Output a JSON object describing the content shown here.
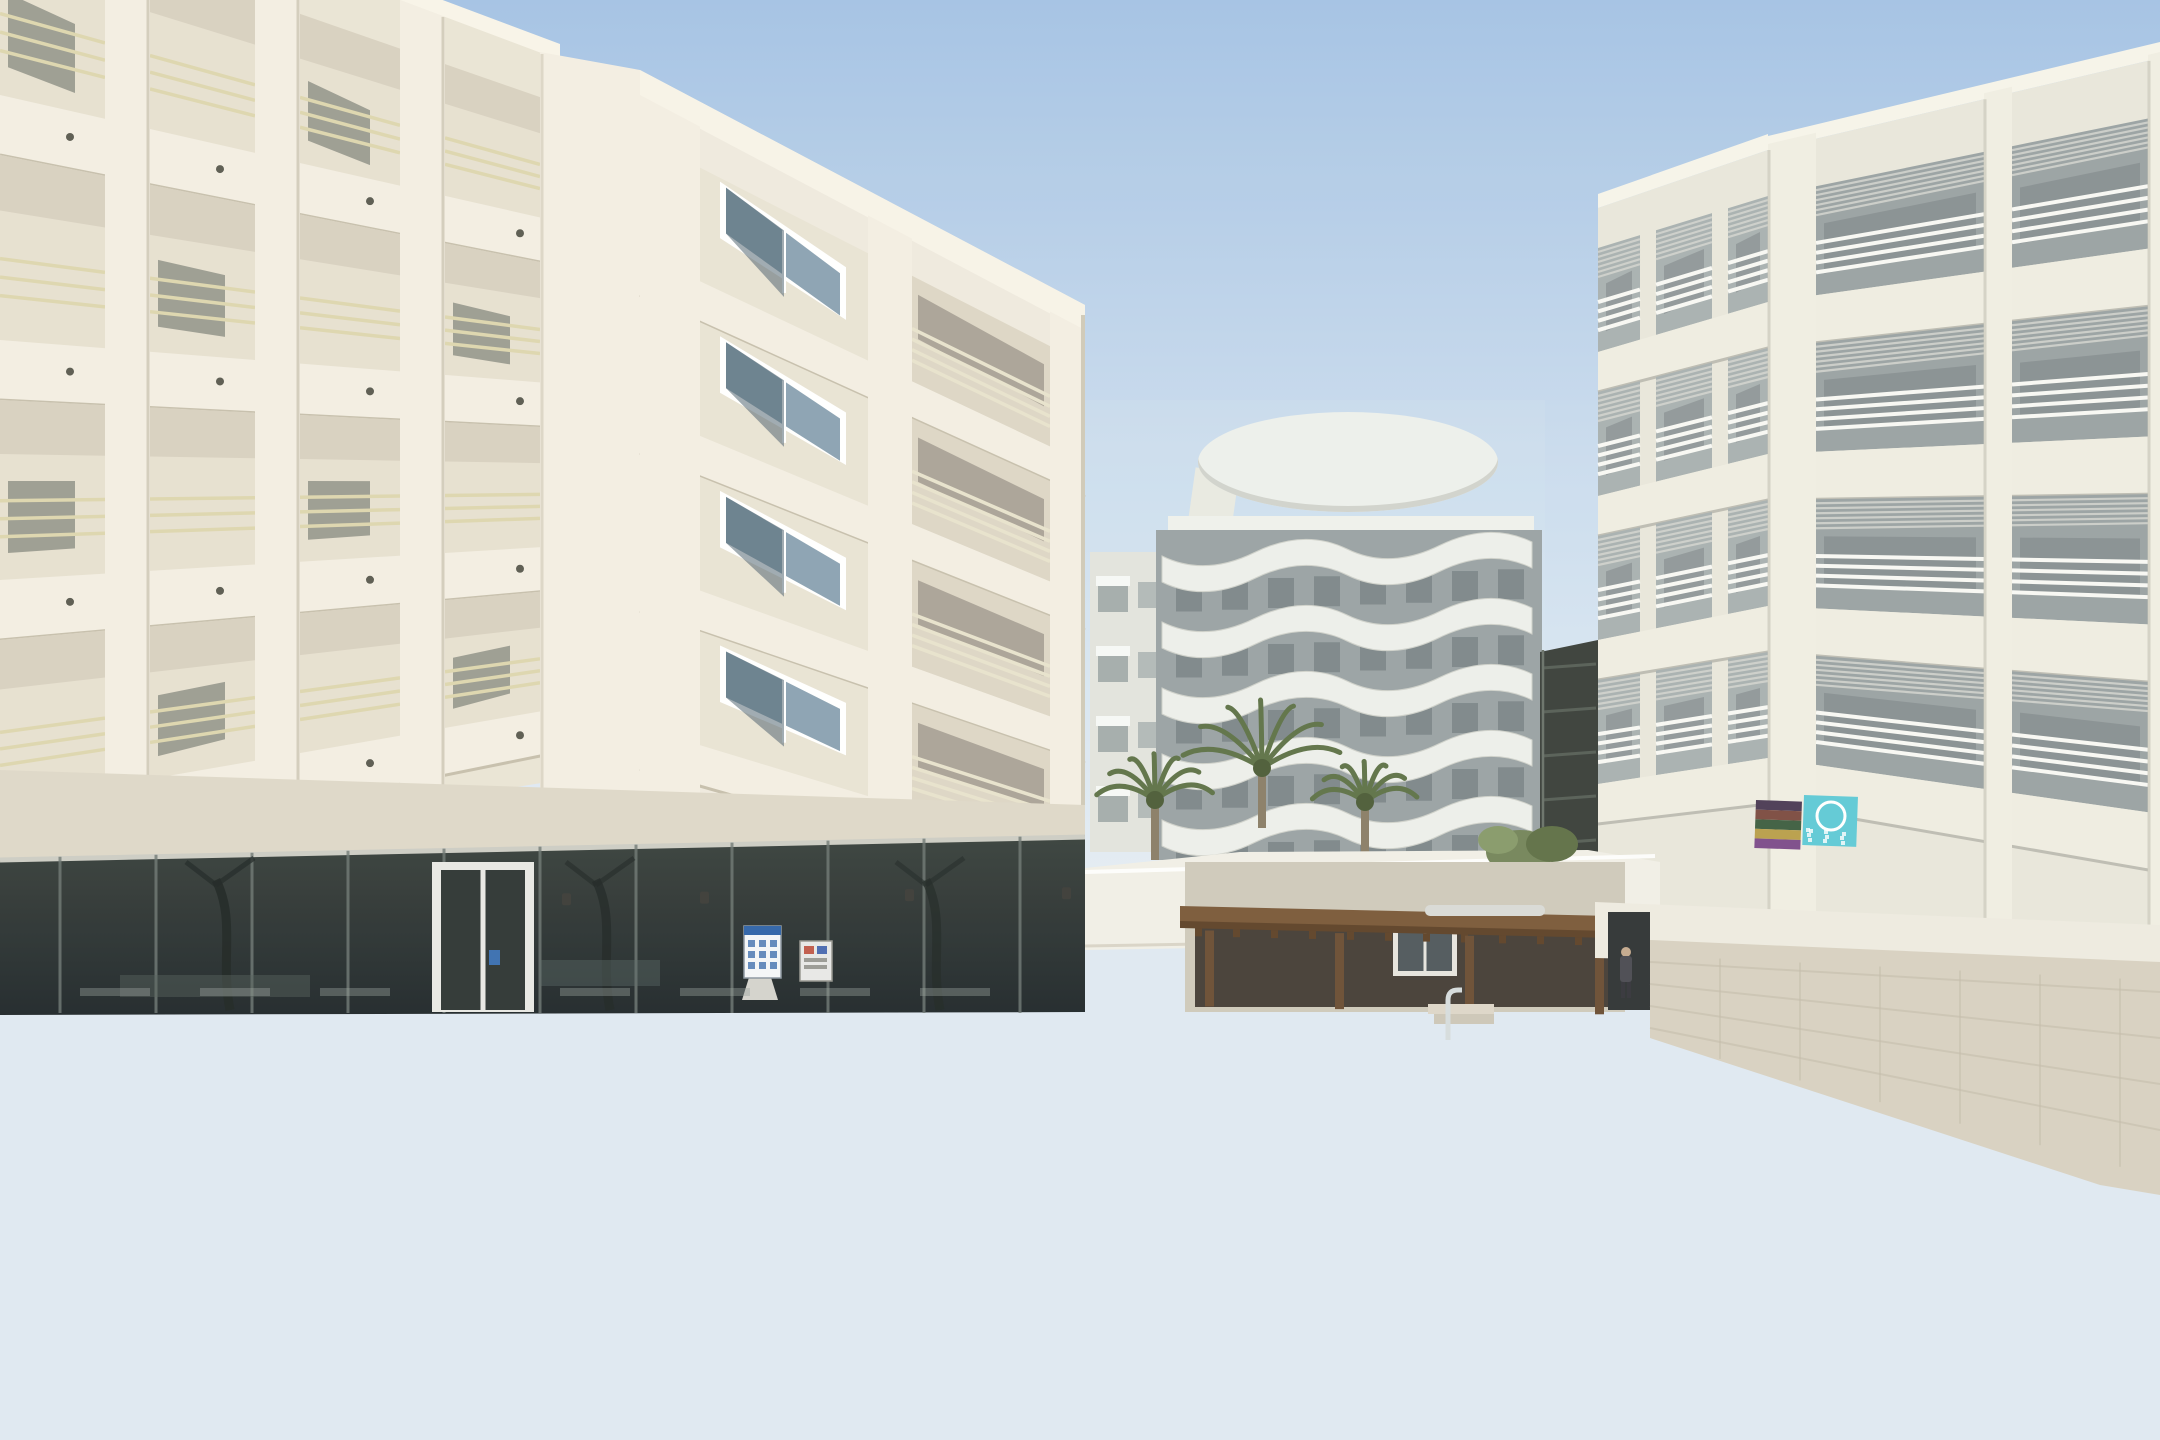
{
  "image": {
    "alt": "Sunny hotel courtyard: white apartment buildings with balconies surround a curvy blue swimming pool with a row of in-pool mosaic stools, chrome safety fence, two pool ladders, cream sun loungers, closed parasols, terrace chairs, a wooden pool bar pergola, palm fronds in the left foreground, an orange lifebuoy on the right wall and beach towels on a balcony rail."
  },
  "palette": {
    "sky_top": "#a9c6e6",
    "sky_mid": "#c9dbee",
    "sky_low": "#e3ecf4",
    "cream_light": "#f3eee2",
    "cream": "#eae4d5",
    "cream_shadow": "#d9d2bf",
    "slab_shadow": "#c6bfac",
    "rail_yellow": "#ddd6ae",
    "tower_face": "#efeade",
    "glass_dark": "#343d3a",
    "glass_mullion": "#6e7874",
    "right_face": "#e9e7db",
    "right_cell": "#9aa2a3",
    "right_rail": "#f8f8f4",
    "slat": "#d3d5cf",
    "wavy_white": "#f0f0ea",
    "wavy_dark": "#8e9697",
    "shaft": "#3a3f3a",
    "wood": "#7a5939",
    "wood_dark": "#5e4228",
    "bar_interior": "#453e37",
    "stone_wall": "#d8d1c1",
    "white_wall": "#eeebe0",
    "deck": "#e9e3d5",
    "deck_bright": "#f3edde",
    "deck_warm": "#e6d6c0",
    "terrace_shade": "#d7d2c5",
    "coping": "#d8a97c",
    "coping_dark": "#c08d62",
    "water_top": "#2e97cf",
    "water_main": "#6cbede",
    "water_right": "#2b86ba",
    "water_shallow": "#d7ecf4",
    "waterline_dark": "#15597f",
    "mosaic_band": "#7cc3de",
    "stool_cap": "#f4f6f2",
    "mosaic1": "#6fa9c8",
    "mosaic2": "#93c6da",
    "stool_shadow": "#1d6f9e",
    "bench_band": "#a7cdd3",
    "chrome": "#d6dcdd",
    "chrome_dark": "#8d989c",
    "chrome_bright": "#f2f5f4",
    "umbrella_cream": "#e9dcc0",
    "umbrella_white": "#efece4",
    "palm": "#7f9455",
    "palm_dark": "#5c7040",
    "lifebuoy_orange": "#e2683a",
    "towel_teal": "#5fc9d6",
    "pink": "#d86f9c",
    "lamp_grey": "#8f9496",
    "bin_grey": "#9aa2a4",
    "person_dark": "#4a4a52"
  },
  "left_building": {
    "faceA": {
      "x0": 0,
      "x1": 560,
      "ys0": [
        -150,
        95,
        340,
        580,
        805
      ],
      "ys1": [
        60,
        222,
        384,
        546,
        708
      ],
      "th0": 60,
      "th1": 44,
      "bays": [
        [
          0,
          105
        ],
        [
          150,
          255
        ],
        [
          300,
          400
        ],
        [
          445,
          540
        ]
      ]
    },
    "faceB": {
      "x0": 640,
      "x1": 1085,
      "ys0": [
        95,
        253,
        411,
        569,
        727
      ],
      "ys1": [
        330,
        463,
        596,
        729,
        862
      ],
      "th0": 42,
      "th1": 34,
      "window_bay": [
        700,
        868
      ],
      "balcony_bay": [
        912,
        1050
      ]
    }
  },
  "right_building": {
    "main": {
      "x0": 1768,
      "x1": 2160,
      "ys0": [
        150,
        302,
        454,
        606,
        758
      ],
      "ys1": [
        58,
        247,
        436,
        625,
        814
      ],
      "th0": 46,
      "th1": 58,
      "bays": [
        [
          1816,
          1984
        ],
        [
          2012,
          2148
        ]
      ],
      "piers": [
        [
          1768,
          1816
        ],
        [
          1984,
          2012
        ],
        [
          2148,
          2160
        ]
      ]
    },
    "wing": {
      "x0": 1598,
      "x1": 1768,
      "ys0": [
        208,
        352,
        496,
        640,
        784
      ],
      "ys1": [
        150,
        302,
        454,
        606,
        758
      ],
      "th0": 40,
      "th1": 46,
      "bays": [
        [
          1598,
          1640
        ],
        [
          1656,
          1712
        ],
        [
          1728,
          1768
        ]
      ]
    }
  },
  "wavy_building": {
    "x0": 1162,
    "x1": 1532,
    "rows": 5,
    "y_start": 556,
    "pitch": 66,
    "slope": -14,
    "amp": 15,
    "band_h": 26,
    "crown": {
      "cx": 1348,
      "cy": 462,
      "rx": 150,
      "ry": 50
    }
  },
  "fence": {
    "bar_step": 17,
    "sections": [
      {
        "x0": 597,
        "yt0": 1012,
        "x1": 1105,
        "yt1": 1008,
        "yb0": 1095,
        "yb1": 1118,
        "posts": [
          597,
          766,
          935,
          1104
        ]
      },
      {
        "x0": 1105,
        "yt0": 1008,
        "x1": 1450,
        "yt1": 1052,
        "yb0": 1118,
        "yb1": 1205,
        "posts": [
          1277,
          1450
        ]
      },
      {
        "x0": 1450,
        "yt0": 1052,
        "x1": 1622,
        "yt1": 1086,
        "yb0": 1205,
        "yb1": 1250,
        "posts": [
          1622
        ]
      }
    ],
    "end_post": {
      "x": 1622,
      "y0": 1086,
      "y1": 1345
    }
  },
  "stools": {
    "count": 18,
    "x0": 622,
    "y0": 1120,
    "x1": 1520,
    "y1": 1323
  },
  "chair_rows": [
    {
      "x0": 1235,
      "x1": 1585,
      "y": 1004,
      "s": 0.72,
      "step": 25,
      "frame": "#6e6253",
      "dark": "#514538"
    },
    {
      "x0": 636,
      "x1": 1235,
      "y": 1012,
      "s": 0.8,
      "step": 28,
      "frame": "#a59880",
      "dark": "#7d7260"
    },
    {
      "x0": 520,
      "x1": 1150,
      "y": 1058,
      "s": 0.95,
      "step": 30,
      "frame": "#b3a78d",
      "dark": "#887d67"
    },
    {
      "x0": 1150,
      "x1": 1478,
      "y": 1062,
      "s": 0.95,
      "step": 31,
      "frame": "#ab9f87",
      "dark": "#81765f"
    }
  ],
  "tables": [
    {
      "x": 880,
      "y": 1000,
      "w": 64
    },
    {
      "x": 1010,
      "y": 998,
      "w": 64
    },
    {
      "x": 1140,
      "y": 1000,
      "w": 60
    }
  ],
  "planks": {
    "left": {
      "n": 12,
      "x0": 0,
      "y0": 1118,
      "x1": 880,
      "y1": 1200,
      "dy0": 27,
      "dy1": 23
    },
    "right": {
      "n": 9,
      "x0": 1600,
      "y0": 1160,
      "x1": 2160,
      "y1": 1128,
      "dy0": 34,
      "dy1": 37
    }
  },
  "fronds": [
    {
      "p0": [
        10,
        720
      ],
      "c": [
        260,
        640
      ],
      "p1": [
        520,
        720
      ],
      "n": 14,
      "len": 60,
      "color": "#5a6d3e"
    },
    {
      "p0": [
        40,
        690
      ],
      "c": [
        300,
        615
      ],
      "p1": [
        565,
        700
      ],
      "n": 16,
      "len": 68,
      "color": "#8fa45f"
    },
    {
      "p0": [
        25,
        745
      ],
      "c": [
        320,
        680
      ],
      "p1": [
        645,
        818
      ],
      "n": 16,
      "len": 78,
      "color": "#7c9150"
    },
    {
      "p0": [
        15,
        800
      ],
      "c": [
        330,
        778
      ],
      "p1": [
        705,
        948
      ],
      "n": 17,
      "len": 84,
      "color": "#87a05c"
    },
    {
      "p0": [
        10,
        860
      ],
      "c": [
        305,
        880
      ],
      "p1": [
        765,
        1040
      ],
      "n": 17,
      "len": 80,
      "color": "#6f8549"
    },
    {
      "p0": [
        30,
        922
      ],
      "c": [
        265,
        958
      ],
      "p1": [
        655,
        1063
      ],
      "n": 15,
      "len": 70,
      "color": "#7e9455"
    },
    {
      "p0": [
        0,
        642
      ],
      "c": [
        185,
        560
      ],
      "p1": [
        425,
        580
      ],
      "n": 12,
      "len": 58,
      "color": "#93a865"
    },
    {
      "p0": [
        0,
        985
      ],
      "c": [
        205,
        1012
      ],
      "p1": [
        435,
        1062
      ],
      "n": 12,
      "len": 54,
      "color": "#6d8148"
    },
    {
      "p0": [
        0,
        900
      ],
      "c": [
        180,
        930
      ],
      "p1": [
        400,
        1000
      ],
      "n": 12,
      "len": 60,
      "color": "#5c7040"
    }
  ],
  "bg_palms": [
    {
      "cx": 1155,
      "cy": 800,
      "r": 62
    },
    {
      "cx": 1262,
      "cy": 768,
      "r": 84
    },
    {
      "cx": 1365,
      "cy": 802,
      "r": 56
    }
  ],
  "umbrellas": [
    {
      "x": 430,
      "y0": 948,
      "y1": 1118,
      "w": 46,
      "c": "#e9dcc0",
      "lean": 0
    },
    {
      "x": 205,
      "y0": 950,
      "y1": 1038,
      "w": 26,
      "c": "#efece4",
      "lean": -8
    },
    {
      "x": 312,
      "y0": 958,
      "y1": 1042,
      "w": 24,
      "c": "#efece4",
      "lean": 6
    },
    {
      "x": 806,
      "y0": 930,
      "y1": 1076,
      "w": 26,
      "c": "#efece4",
      "lean": 0
    },
    {
      "x": 858,
      "y0": 925,
      "y1": 1072,
      "w": 24,
      "c": "#a7acab",
      "lean": 0
    },
    {
      "x": 912,
      "y0": 932,
      "y1": 1076,
      "w": 26,
      "c": "#efece4",
      "lean": 0
    },
    {
      "x": 1456,
      "y0": 902,
      "y1": 1008,
      "w": 20,
      "c": "#eceadf",
      "lean": 0
    },
    {
      "x": 1612,
      "y0": 952,
      "y1": 1034,
      "w": 20,
      "c": "#efece4",
      "lean": 0
    }
  ],
  "water_streaks": {
    "center_x0": 680,
    "center_x1": 1430,
    "step": 74,
    "right_dark": [
      1672,
      1702,
      1736,
      1776,
      1820
    ],
    "right_light": [
      1860,
      1905,
      1945,
      1985
    ]
  },
  "sparkles": {
    "count": 16,
    "cx": 660,
    "cy": 1262,
    "rx": 180,
    "ry": 62
  },
  "towel_rainbow": [
    "#4b3b55",
    "#7c4b41",
    "#3e5e41",
    "#b99f4a",
    "#7c4b8a"
  ],
  "people": [
    {
      "x": 1626,
      "y": 952
    },
    {
      "x": 1160,
      "y": 972
    }
  ]
}
